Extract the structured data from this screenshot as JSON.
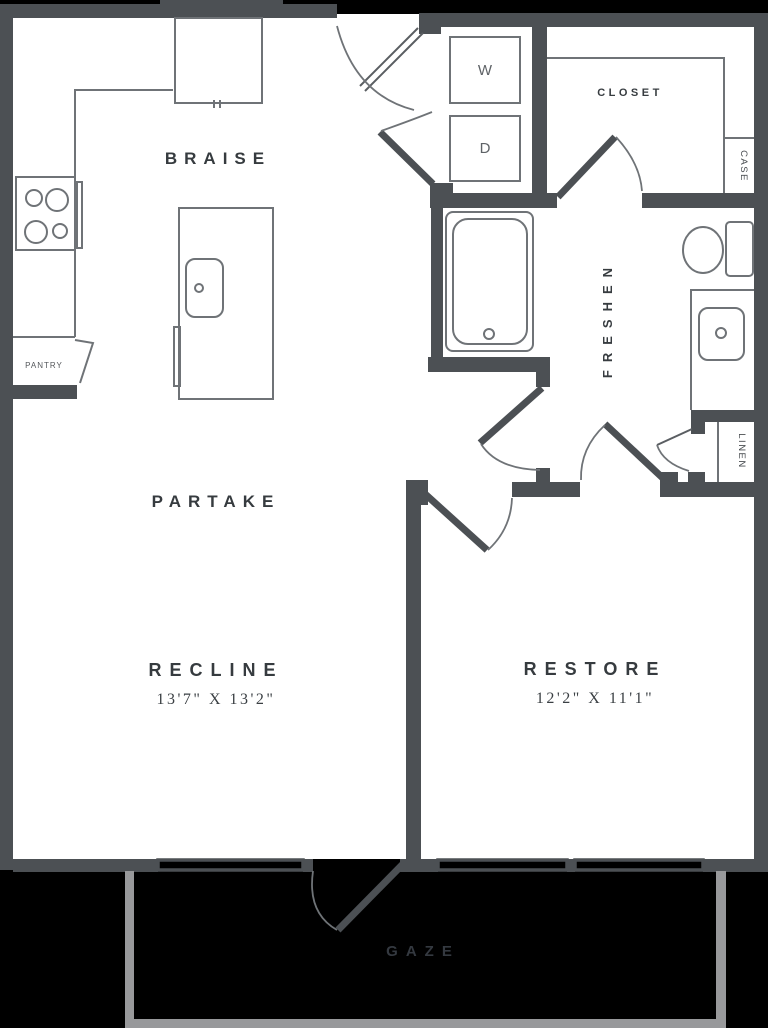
{
  "meta": {
    "type": "apartment-floor-plan",
    "background_color": "#000000",
    "wall_color": "#4c5054",
    "fixture_line_color": "#6f7377",
    "label_color": "#363b3f",
    "balcony_wall_color": "#98999b"
  },
  "rooms": {
    "kitchen": {
      "label": "BRAISE"
    },
    "dining": {
      "label": "PARTAKE"
    },
    "living": {
      "label": "RECLINE",
      "dimensions": "13'7\" X 13'2\""
    },
    "bedroom": {
      "label": "RESTORE",
      "dimensions": "12'2\" X 11'1\""
    },
    "bathroom": {
      "label": "FRESHEN"
    },
    "closet": {
      "label": "CLOSET"
    },
    "case": {
      "label": "CASE"
    },
    "linen": {
      "label": "LINEN"
    },
    "pantry": {
      "label": "PANTRY"
    },
    "balcony": {
      "label": "GAZE"
    },
    "washer": {
      "label": "W"
    },
    "dryer": {
      "label": "D"
    }
  }
}
